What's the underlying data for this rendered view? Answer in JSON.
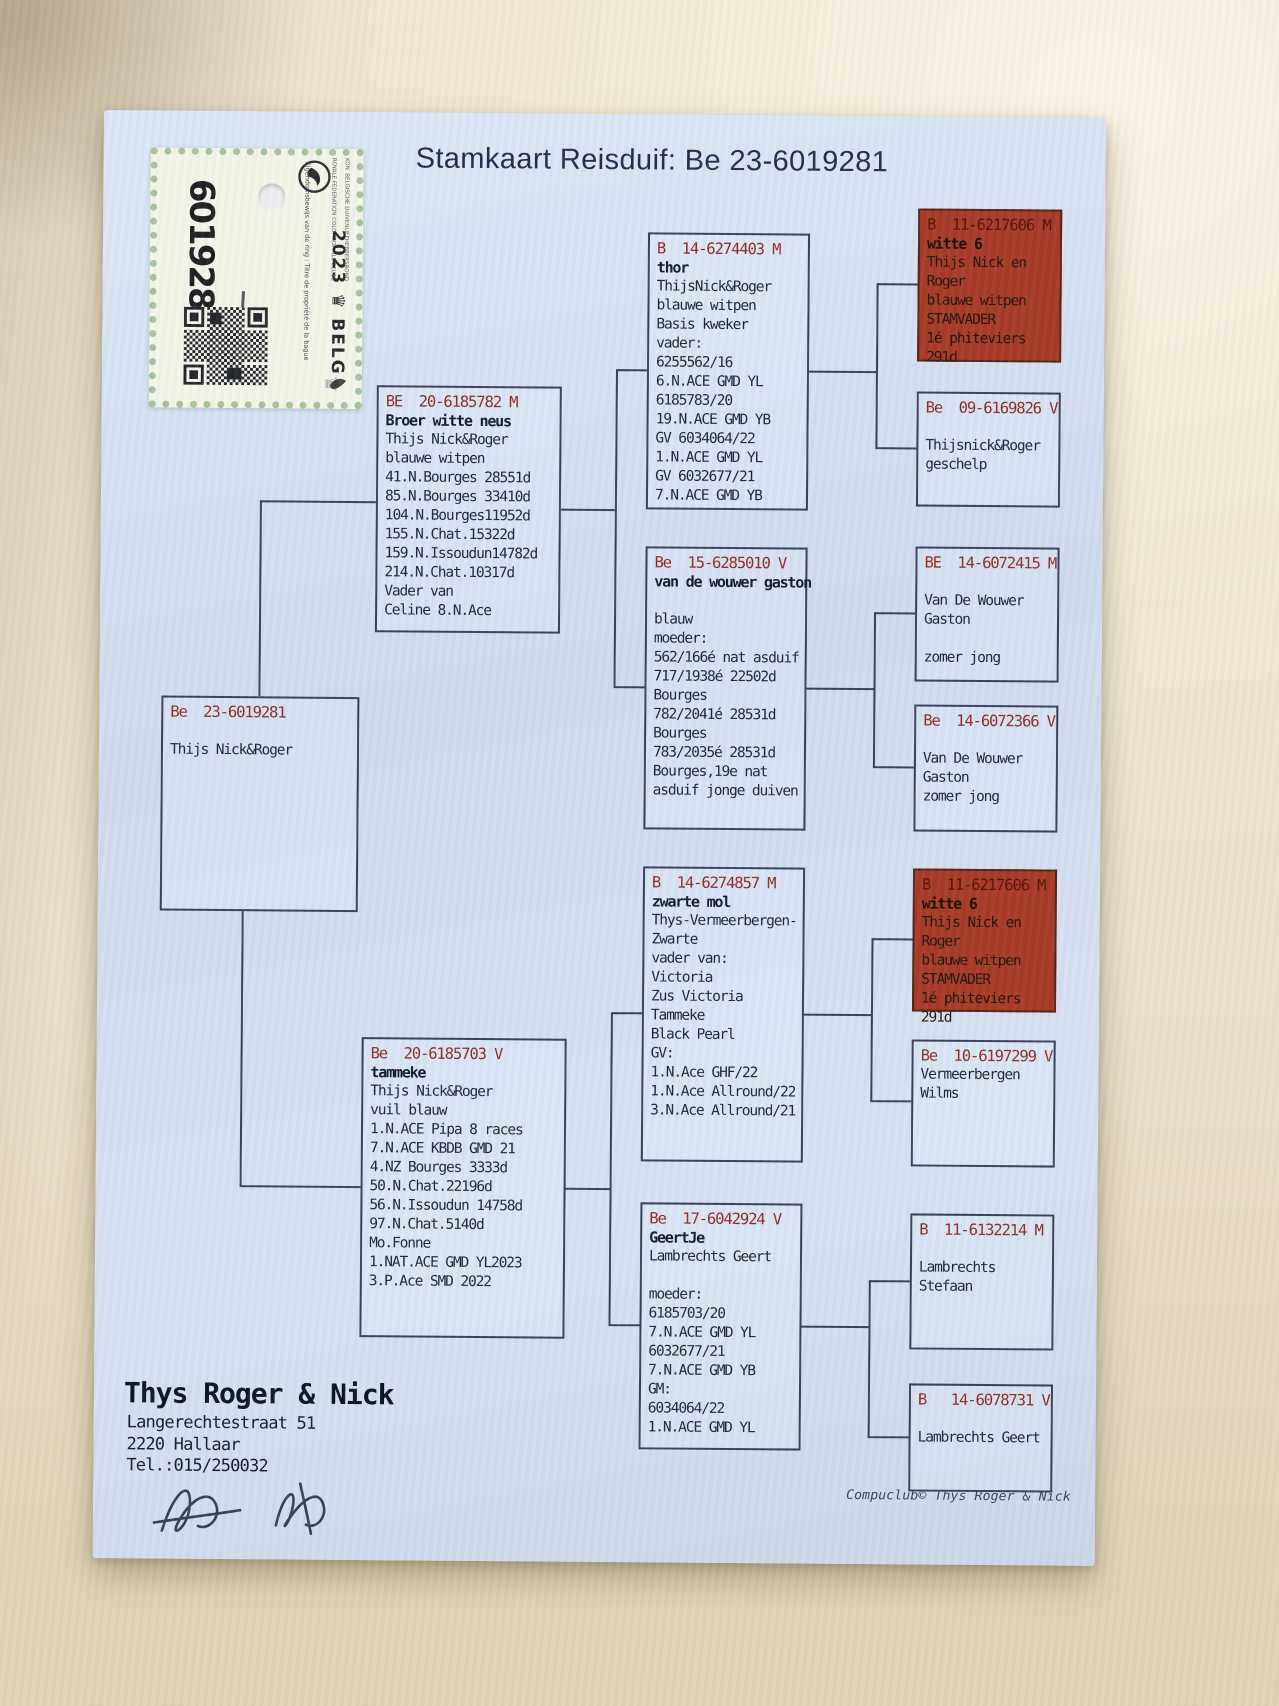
{
  "title": "Stamkaart Reisduif: Be 23-6019281",
  "ring_sticker": {
    "number": "6019281",
    "year_country": "2023 ♛ BELG",
    "federation_line1": "KON. BELGISCHE DUIVENLIEFHEBBERSBOND",
    "federation_line2": "ROYALE FEDERATION COLOMBOPHILE BELGE",
    "ownership_text": "Eigendomsbewijs van de ring : Titre de propriété de la bague"
  },
  "pedigree": {
    "root": {
      "header": "Be  23-6019281",
      "name": "",
      "body": "\nThijs Nick&Roger"
    },
    "sire": {
      "header": "BE  20-6185782 M",
      "name": "Broer witte neus",
      "body": "Thijs Nick&Roger\nblauwe witpen\n41.N.Bourges 28551d\n85.N.Bourges 33410d\n104.N.Bourges11952d\n155.N.Chat.15322d\n159.N.Issoudun14782d\n214.N.Chat.10317d\nVader van\nCeline 8.N.Ace"
    },
    "dam": {
      "header": "Be  20-6185703 V",
      "name": "tammeke",
      "body": "Thijs Nick&Roger\nvuil blauw\n1.N.ACE Pipa 8 races\n7.N.ACE KBDB GMD 21\n4.NZ Bourges 3333d\n50.N.Chat.22196d\n56.N.Issoudun 14758d\n97.N.Chat.5140d\nMo.Fonne\n1.NAT.ACE GMD YL2023\n3.P.Ace SMD 2022"
    },
    "pgf_thor": {
      "header": "B  14-6274403 M",
      "name": "thor",
      "body": "ThijsNick&Roger\nblauwe witpen\nBasis kweker\nvader:\n6255562/16\n6.N.ACE GMD YL\n6185783/20\n19.N.ACE GMD YB\nGV 6034064/22\n1.N.ACE GMD YL\nGV 6032677/21\n7.N.ACE GMD YB"
    },
    "pgm_gaston": {
      "header": "Be  15-6285010 V",
      "name": "van de wouwer gaston",
      "body": "\nblauw\nmoeder:\n562/166é nat asduif\n717/1938é 22502d\nBourges\n782/2041é 28531d\nBourges\n783/2035é 28531d\nBourges,19e nat\nasduif jonge duiven"
    },
    "mgf_zwartemol": {
      "header": "B  14-6274857 M",
      "name": "zwarte mol",
      "body": "Thys-Vermeerbergen-\nZwarte\nvader van:\nVictoria\nZus Victoria\nTammeke\nBlack Pearl\nGV:\n1.N.Ace GHF/22\n1.N.Ace Allround/22\n3.N.Ace Allround/21"
    },
    "mgm_geertje": {
      "header": "Be  17-6042924 V",
      "name": "GeertJe",
      "body": "Lambrechts Geert\n\nmoeder:\n6185703/20\n7.N.ACE GMD YL\n6032677/21\n7.N.ACE GMD YB\nGM:\n6034064/22\n1.N.ACE GMD YL"
    },
    "ggp1_witte6": {
      "header": "B  11-6217606 M",
      "name": "witte 6",
      "body": "Thijs Nick en Roger\nblauwe witpen\nSTAMVADER\n1é phiteviers 291d"
    },
    "ggp2": {
      "header": "Be  09-6169826 V",
      "name": "",
      "body": "\nThijsnick&Roger\ngeschelp"
    },
    "ggp3": {
      "header": "BE  14-6072415 M",
      "name": "",
      "body": "\nVan De Wouwer Gaston\n\nzomer jong"
    },
    "ggp4": {
      "header": "Be  14-6072366 V",
      "name": "",
      "body": "\nVan De Wouwer Gaston\nzomer jong"
    },
    "ggp5_witte6": {
      "header": "B  11-6217606 M",
      "name": "witte 6",
      "body": "Thijs Nick en Roger\nblauwe witpen\nSTAMVADER\n1é phiteviers 291d"
    },
    "ggp6": {
      "header": "Be  10-6197299 V",
      "name": "",
      "body": "Vermeerbergen Wilms"
    },
    "ggp7": {
      "header": "B  11-6132214 M",
      "name": "",
      "body": "\nLambrechts Stefaan"
    },
    "ggp8": {
      "header": "B   14-6078731 V",
      "name": "",
      "body": "\nLambrechts Geert"
    }
  },
  "owner": {
    "name": "Thys Roger & Nick",
    "address_line1": "Langerechtestraat 51",
    "address_line2": "2220  Hallaar",
    "phone": "Tel.:015/250032"
  },
  "footer": {
    "credit": "Compuclub© Thys Roger & Nick"
  },
  "colors": {
    "header_red": "#8f2d26",
    "highlight_box_bg": "#a63a27",
    "ink": "#20263a",
    "paper_blue": "#d3dff0"
  }
}
